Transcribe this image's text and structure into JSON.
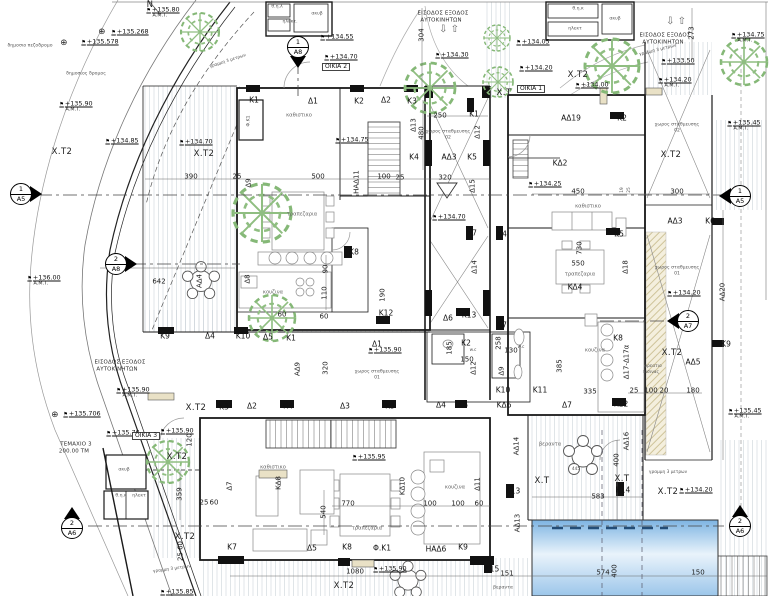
{
  "plan": {
    "drawing_type": "architectural ground floor site plan",
    "houses": [
      "ΟΙΚΙΑ 1",
      "ΟΙΚΙΑ 2",
      "ΟΙΚΙΑ 3"
    ],
    "parcel": {
      "name": "ΤΕΜΑΧΙΟ 3",
      "area": "200.00 ΤΜ"
    },
    "colors": {
      "wall": "#1a1a1a",
      "thin": "#555555",
      "hatch": "#ccd3d9",
      "tree": "#85b877",
      "ramp_hatch": "#cfc49a",
      "pool_top": "#7db4e2",
      "pool_mid": "#e9f3fb",
      "pool_bottom": "#9cc6ea",
      "pool_lane": "#234d77",
      "door_fill": "#e9e1c6"
    },
    "markers": [
      {
        "num": "1",
        "sheet": "Α8",
        "x": 298,
        "y": 47,
        "dir": "down"
      },
      {
        "num": "2",
        "sheet": "Α8",
        "x": 116,
        "y": 264,
        "dir": "right"
      },
      {
        "num": "1",
        "sheet": "Α5",
        "x": 21,
        "y": 194,
        "dir": "right"
      },
      {
        "num": "1",
        "sheet": "Α5",
        "x": 740,
        "y": 196,
        "dir": "left"
      },
      {
        "num": "2",
        "sheet": "Α7",
        "x": 688,
        "y": 321,
        "dir": "left"
      },
      {
        "num": "2",
        "sheet": "Α6",
        "x": 72,
        "y": 528,
        "dir": "up"
      },
      {
        "num": "2",
        "sheet": "Α6",
        "x": 740,
        "y": 526,
        "dir": "up"
      }
    ],
    "labels": [
      [
        "δημοσιο πεζοδρομο",
        30,
        47,
        "r4"
      ],
      [
        "δημοσιος δρομος",
        86,
        75,
        "r4"
      ],
      [
        "N",
        150,
        5,
        "x"
      ],
      [
        "+135.80",
        163,
        10,
        "v"
      ],
      [
        "Α.Μ.Τ.",
        160,
        17,
        "a"
      ],
      [
        "⊕",
        102,
        32,
        "x"
      ],
      [
        "+135.268",
        130,
        32,
        "v"
      ],
      [
        "+135.90",
        76,
        104,
        "v"
      ],
      [
        "Α.Μ.Τ.",
        73,
        111,
        "a"
      ],
      [
        "+134.85",
        122,
        141,
        "v"
      ],
      [
        "Χ.Τ2",
        62,
        152,
        "x"
      ],
      [
        "+134.70",
        196,
        142,
        "v"
      ],
      [
        "Χ.Τ2",
        204,
        154,
        "x"
      ],
      [
        "⊕",
        64,
        43,
        "x"
      ],
      [
        "+135.578",
        100,
        42,
        "v"
      ],
      [
        "+136.00",
        44,
        278,
        "v"
      ],
      [
        "Α.Μ.Τ.",
        41,
        285,
        "a"
      ],
      [
        "⊕",
        55,
        415,
        "x"
      ],
      [
        "+135.706",
        82,
        414,
        "v"
      ],
      [
        "ΤΕΜΑΧΙΟ 3",
        76,
        445,
        "n"
      ],
      [
        "200.00 ΤΜ",
        74,
        452,
        "n"
      ],
      [
        "γραμμη 3 μετρων",
        228,
        62,
        "t",
        -18
      ],
      [
        "γραμμη 3 μετρων",
        172,
        570,
        "t",
        -8
      ],
      [
        "γραμμη 3 μετρων",
        658,
        51,
        "t",
        -14
      ],
      [
        "γραμμη 3 μετρων",
        668,
        473,
        "t"
      ],
      [
        "ΕΙΣΟΔΟΣ ΕΞΟΔΟΣ",
        120,
        363,
        "n"
      ],
      [
        "ΑΥΤΟΚΙΝΗΤΩΝ",
        117,
        370,
        "n"
      ],
      [
        "+135.90",
        133,
        390,
        "v"
      ],
      [
        "Α.Μ.Τ.",
        130,
        397,
        "a"
      ],
      [
        "+135.85",
        177,
        592,
        "v"
      ],
      [
        "ΕΙΣΟΔΟΣ ΕΞΟΔΟΣ",
        443,
        14,
        "n"
      ],
      [
        "ΑΥΤΟΚΙΝΗΤΩΝ",
        441,
        21,
        "n"
      ],
      [
        "⇩ ⇧",
        449,
        30,
        "ar"
      ],
      [
        "ΕΙΣΟΔΟΣ ΕΞΟΔΟΣ",
        665,
        36,
        "n"
      ],
      [
        "ΑΥΤΟΚΙΝΗΤΩΝ",
        663,
        43,
        "n"
      ],
      [
        "⇩ ⇧",
        676,
        22,
        "ar"
      ],
      [
        "304",
        422,
        35,
        "d",
        -90
      ],
      [
        "273",
        692,
        33,
        "d",
        -90
      ],
      [
        "+134.30",
        452,
        55,
        "v"
      ],
      [
        "+134.75",
        748,
        35,
        "v"
      ],
      [
        "Α.Μ.Τ.",
        745,
        42,
        "a"
      ],
      [
        "+133.50",
        678,
        61,
        "v"
      ],
      [
        "+134.20",
        675,
        80,
        "v"
      ],
      [
        "Α.Μ.Τ.",
        672,
        87,
        "a"
      ],
      [
        "+135.45",
        744,
        123,
        "v"
      ],
      [
        "Α.Μ.Τ.",
        741,
        130,
        "a"
      ],
      [
        "+134.05",
        533,
        42,
        "v"
      ],
      [
        "+134.20",
        536,
        68,
        "v"
      ],
      [
        "Χ.Τ",
        504,
        93,
        "x"
      ],
      [
        "Χ.Τ2",
        578,
        75,
        "x"
      ],
      [
        "+134.00",
        592,
        85,
        "v"
      ],
      [
        "ΟΙΚΙΑ 1",
        531,
        89,
        "b"
      ],
      [
        "Χ.Τ2",
        671,
        155,
        "x"
      ],
      [
        "θ.η.λ",
        277,
        8,
        "r4"
      ],
      [
        "ακυβ",
        317,
        15,
        "r4"
      ],
      [
        "ηλεκτ.",
        290,
        23,
        "r4"
      ],
      [
        "+134.55",
        337,
        37,
        "v"
      ],
      [
        "+134.70",
        341,
        57,
        "v"
      ],
      [
        "ΟΙΚΙΑ 2",
        336,
        67,
        "b"
      ],
      [
        "Κ1",
        254,
        100,
        "l"
      ],
      [
        "Δ1",
        313,
        101,
        "l"
      ],
      [
        "Κ2",
        359,
        101,
        "l"
      ],
      [
        "Δ2",
        386,
        100,
        "l"
      ],
      [
        "Κ3",
        412,
        101,
        "l"
      ],
      [
        "Κ1",
        474,
        114,
        "l"
      ],
      [
        "Φ.Κ1",
        250,
        121,
        "r4",
        -90
      ],
      [
        "καθιστικο",
        299,
        116,
        "r"
      ],
      [
        "+134.75",
        352,
        140,
        "v"
      ],
      [
        "390",
        191,
        177,
        "d"
      ],
      [
        "25",
        237,
        177,
        "d"
      ],
      [
        "Δ9",
        249,
        183,
        "d",
        -90
      ],
      [
        "500",
        318,
        177,
        "d"
      ],
      [
        "ΗΑΔ11",
        357,
        182,
        "d",
        -90
      ],
      [
        "100",
        384,
        177,
        "d"
      ],
      [
        "25",
        400,
        178,
        "d"
      ],
      [
        "320",
        445,
        178,
        "d"
      ],
      [
        "τραπεζαρια",
        302,
        215,
        "r"
      ],
      [
        "κουζινα",
        273,
        293,
        "r"
      ],
      [
        "90",
        326,
        269,
        "d",
        -90
      ],
      [
        "110",
        325,
        293,
        "d",
        -90
      ],
      [
        "190",
        383,
        295,
        "d",
        -90
      ],
      [
        "60",
        282,
        315,
        "d"
      ],
      [
        "60",
        324,
        317,
        "d"
      ],
      [
        "Κ8",
        354,
        252,
        "l"
      ],
      [
        "Κ12",
        386,
        313,
        "l"
      ],
      [
        "Κ9",
        165,
        336,
        "l"
      ],
      [
        "Δ4",
        210,
        336,
        "l"
      ],
      [
        "Κ10",
        243,
        336,
        "l"
      ],
      [
        "Δ5",
        268,
        337,
        "l"
      ],
      [
        "Κ1",
        291,
        338,
        "l"
      ],
      [
        "642",
        159,
        282,
        "d"
      ],
      [
        "ΑΔ4",
        200,
        281,
        "d",
        -90
      ],
      [
        "Δ8",
        248,
        279,
        "d",
        -90
      ],
      [
        "Δ13",
        414,
        125,
        "d",
        -90
      ],
      [
        "480",
        422,
        133,
        "d",
        -90
      ],
      [
        "250",
        440,
        116,
        "d"
      ],
      [
        "Δ12",
        478,
        132,
        "d",
        -90
      ],
      [
        "χωρος σταθμευσης",
        448,
        133,
        "r4"
      ],
      [
        "02",
        448,
        139,
        "r4"
      ],
      [
        "Κ4",
        414,
        157,
        "l"
      ],
      [
        "ΑΔ3",
        449,
        157,
        "l"
      ],
      [
        "Κ5",
        472,
        157,
        "l"
      ],
      [
        "Δ15",
        473,
        186,
        "d",
        -90
      ],
      [
        "+134.70",
        449,
        217,
        "v"
      ],
      [
        "Κ7",
        472,
        233,
        "l"
      ],
      [
        "Κ4",
        502,
        234,
        "l"
      ],
      [
        "Δ14",
        475,
        267,
        "d",
        -90
      ],
      [
        "Δ1",
        377,
        344,
        "l"
      ],
      [
        "+135.90",
        385,
        350,
        "v"
      ],
      [
        "ΑΔ9",
        298,
        369,
        "d",
        -90
      ],
      [
        "320",
        326,
        368,
        "d",
        -90
      ],
      [
        "χωρος σταθμευσης",
        377,
        373,
        "r4"
      ],
      [
        "01",
        377,
        379,
        "r4"
      ],
      [
        "Δ6",
        448,
        318,
        "l"
      ],
      [
        "Κ13",
        469,
        315,
        "l"
      ],
      [
        "Κ7",
        502,
        325,
        "l"
      ],
      [
        "Κ2",
        466,
        343,
        "l"
      ],
      [
        "w.c",
        473,
        351,
        "t"
      ],
      [
        "185",
        450,
        348,
        "d",
        -90
      ],
      [
        "150",
        467,
        360,
        "d"
      ],
      [
        "Δ12",
        474,
        368,
        "d",
        -90
      ],
      [
        "258",
        499,
        343,
        "d",
        -90
      ],
      [
        "130",
        511,
        351,
        "d"
      ],
      [
        "w.c",
        521,
        348,
        "t"
      ],
      [
        "Δ9",
        502,
        371,
        "d",
        -90
      ],
      [
        "Κ10",
        503,
        390,
        "l"
      ],
      [
        "ΚΔ6",
        504,
        405,
        "l"
      ],
      [
        "Κ11",
        540,
        390,
        "l"
      ],
      [
        "θ.η.κ",
        578,
        10,
        "r4"
      ],
      [
        "ακυβ",
        615,
        20,
        "r4"
      ],
      [
        "ηλεκτ",
        575,
        30,
        "r4"
      ],
      [
        "ΑΔ19",
        571,
        118,
        "l"
      ],
      [
        "Κ2",
        622,
        118,
        "l"
      ],
      [
        "ΚΔ2",
        560,
        163,
        "l"
      ],
      [
        "+134.25",
        545,
        184,
        "v"
      ],
      [
        "450",
        578,
        192,
        "d"
      ],
      [
        "300",
        677,
        192,
        "d"
      ],
      [
        "19",
        623,
        190,
        "t",
        -90
      ],
      [
        "25",
        630,
        190,
        "t",
        -90
      ],
      [
        "καθιστικο",
        588,
        207,
        "r"
      ],
      [
        "Κ5",
        619,
        234,
        "l"
      ],
      [
        "730",
        580,
        248,
        "d",
        -90
      ],
      [
        "550",
        578,
        264,
        "d"
      ],
      [
        "τραπεζαρια",
        580,
        275,
        "r"
      ],
      [
        "ΚΔ4",
        575,
        287,
        "l"
      ],
      [
        "Δ18",
        626,
        267,
        "d",
        -90
      ],
      [
        "+134.20",
        684,
        293,
        "v"
      ],
      [
        "χωρος σταθμευσης",
        677,
        126,
        "r4"
      ],
      [
        "02",
        677,
        132,
        "r4"
      ],
      [
        "χωρος σταθμευσης",
        677,
        269,
        "r4"
      ],
      [
        "01",
        677,
        275,
        "r4"
      ],
      [
        "ΑΔ3",
        675,
        221,
        "l"
      ],
      [
        "Κ6",
        710,
        221,
        "l"
      ],
      [
        "ΑΔ20",
        723,
        292,
        "d",
        -90
      ],
      [
        "Κ9",
        726,
        344,
        "l"
      ],
      [
        "385",
        560,
        366,
        "d",
        -90
      ],
      [
        "κουζινα",
        595,
        351,
        "r"
      ],
      [
        "Κ8",
        618,
        338,
        "l"
      ],
      [
        "Δ17-Δ17α",
        627,
        362,
        "d",
        -90
      ],
      [
        "335",
        590,
        392,
        "d"
      ],
      [
        "25",
        634,
        391,
        "d"
      ],
      [
        "100",
        651,
        391,
        "d"
      ],
      [
        "20",
        664,
        391,
        "d"
      ],
      [
        "180",
        693,
        391,
        "d"
      ],
      [
        "ΑΔ5",
        693,
        362,
        "l"
      ],
      [
        "φρεατιο",
        653,
        367,
        "t"
      ],
      [
        "πισινας",
        651,
        373,
        "t"
      ],
      [
        "Χ.Τ2",
        672,
        353,
        "x"
      ],
      [
        "Δ7",
        567,
        405,
        "l"
      ],
      [
        "Κ12",
        621,
        404,
        "l"
      ],
      [
        "+135.45",
        745,
        411,
        "v"
      ],
      [
        "Α.Μ.Τ.",
        742,
        418,
        "a"
      ],
      [
        "ΑΔ14",
        517,
        446,
        "d",
        -90
      ],
      [
        "βεραντα",
        550,
        445,
        "r"
      ],
      [
        "445",
        576,
        470,
        "t"
      ],
      [
        "Χ.Τ",
        542,
        481,
        "x"
      ],
      [
        "Κ13",
        513,
        491,
        "l"
      ],
      [
        "583",
        598,
        497,
        "d"
      ],
      [
        "ΑΔ13",
        518,
        523,
        "d",
        -90
      ],
      [
        "ΑΔ16",
        627,
        441,
        "d",
        -90
      ],
      [
        "400",
        617,
        460,
        "d",
        -90
      ],
      [
        "Χ.Τ",
        622,
        479,
        "x"
      ],
      [
        "Κ14",
        623,
        490,
        "l"
      ],
      [
        "Χ.Τ2",
        668,
        492,
        "x"
      ],
      [
        "+134.20",
        696,
        490,
        "v"
      ],
      [
        "Κ15",
        492,
        569,
        "l"
      ],
      [
        "151",
        507,
        574,
        "d"
      ],
      [
        "574",
        603,
        573,
        "d"
      ],
      [
        "400",
        615,
        571,
        "d",
        -90
      ],
      [
        "150",
        698,
        573,
        "d"
      ],
      [
        "βεραντα",
        503,
        589,
        "r4"
      ],
      [
        "Χ.Τ2",
        196,
        408,
        "x"
      ],
      [
        "Κ3",
        224,
        407,
        "l"
      ],
      [
        "Δ2",
        252,
        406,
        "l"
      ],
      [
        "Κ4",
        288,
        406,
        "l"
      ],
      [
        "Δ3",
        345,
        406,
        "l"
      ],
      [
        "Κ5",
        390,
        406,
        "l"
      ],
      [
        "Δ4",
        441,
        405,
        "l"
      ],
      [
        "Κ6",
        463,
        405,
        "l"
      ],
      [
        "+135.76",
        123,
        433,
        "v"
      ],
      [
        "ΟΙΚΙΑ 3",
        146,
        436,
        "b"
      ],
      [
        "+135.90",
        177,
        431,
        "v"
      ],
      [
        "120",
        190,
        440,
        "d",
        -90
      ],
      [
        "Χ.Τ2",
        177,
        457,
        "x"
      ],
      [
        "359",
        180,
        494,
        "d",
        -90
      ],
      [
        "ακυβ",
        124,
        471,
        "r4"
      ],
      [
        "θ.η.κ",
        121,
        497,
        "r4"
      ],
      [
        "ηλεκτ",
        139,
        497,
        "r4"
      ],
      [
        "Δ7",
        230,
        486,
        "d",
        -90
      ],
      [
        "25",
        204,
        503,
        "d"
      ],
      [
        "60",
        214,
        503,
        "d"
      ],
      [
        "καθιστικο",
        273,
        468,
        "r"
      ],
      [
        "ΚΔ8",
        279,
        483,
        "d",
        -90
      ],
      [
        "+135.95",
        369,
        457,
        "v"
      ],
      [
        "770",
        348,
        504,
        "d"
      ],
      [
        "ΚΔ10",
        403,
        486,
        "d",
        -90
      ],
      [
        "100",
        430,
        504,
        "d"
      ],
      [
        "100",
        458,
        504,
        "d"
      ],
      [
        "60",
        479,
        504,
        "d"
      ],
      [
        "540",
        324,
        512,
        "d",
        -90
      ],
      [
        "κουζινα",
        455,
        488,
        "r"
      ],
      [
        "Δ11",
        478,
        484,
        "d",
        -90
      ],
      [
        "τραπεζαρια",
        367,
        529,
        "r"
      ],
      [
        "Κ7",
        232,
        547,
        "l"
      ],
      [
        "Δ5",
        312,
        548,
        "l"
      ],
      [
        "Κ8",
        347,
        547,
        "l"
      ],
      [
        "Φ.Κ1",
        382,
        548,
        "l"
      ],
      [
        "ΗΑΔ6",
        436,
        549,
        "l"
      ],
      [
        "Κ9",
        463,
        547,
        "l"
      ],
      [
        "Χ.Τ2",
        185,
        537,
        "x"
      ],
      [
        "25 60",
        181,
        551,
        "d",
        -90
      ],
      [
        "1080",
        355,
        572,
        "d"
      ],
      [
        "+135.90",
        390,
        569,
        "v"
      ],
      [
        "Χ.Τ2",
        344,
        586,
        "x"
      ]
    ]
  }
}
